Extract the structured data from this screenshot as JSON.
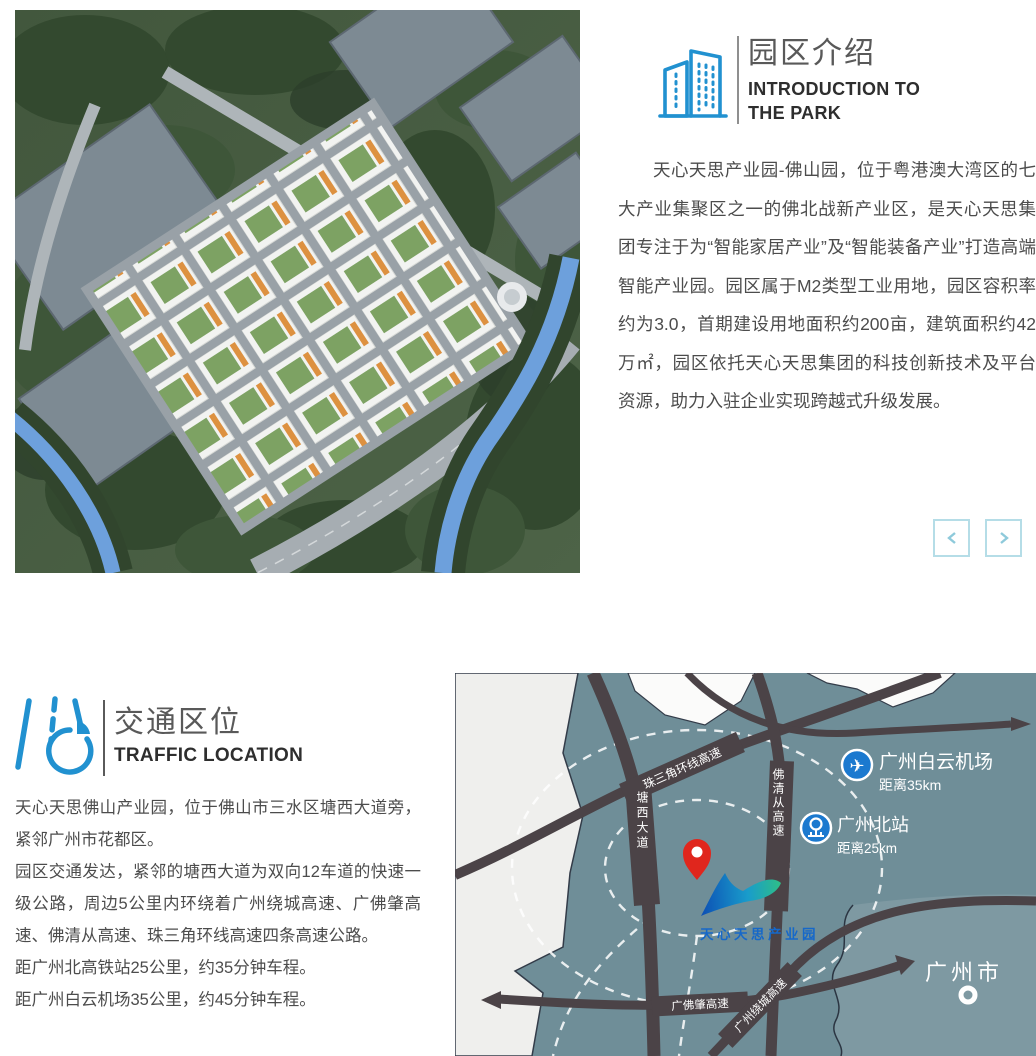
{
  "intro": {
    "title": "园区介绍",
    "subtitle": "INTRODUCTION TO THE PARK",
    "paragraph": "天心天思产业园-佛山园，位于粤港澳大湾区的七大产业集聚区之一的佛北战新产业区，是天心天思集团专注于为“智能家居产业”及“智能装备产业”打造高端智能产业园。园区属于M2类型工业用地，园区容积率约为3.0，首期建设用地面积约200亩，建筑面积约42万㎡，园区依托天心天思集团的科技创新技术及平台资源，助力入驻企业实现跨越式升级发展。"
  },
  "carousel": {
    "prev_label": "‹",
    "next_label": "›"
  },
  "traffic": {
    "title": "交通区位",
    "subtitle": "TRAFFIC LOCATION",
    "paragraphs": [
      "天心天思佛山产业园，位于佛山市三水区塘西大道旁，紧邻广州市花都区。",
      "园区交通发达，紧邻的塘西大道为双向12车道的快速一级公路，周边5公里内环绕着广州绕城高速、广佛肇高速、佛清从高速、珠三角环线高速四条高速公路。",
      "距广州北高铁站25公里，约35分钟车程。",
      "距广州白云机场35公里，约45分钟车程。"
    ]
  },
  "map": {
    "park_label": "天心天思产业园",
    "airport_name": "广州白云机场",
    "airport_distance": "距离35km",
    "station_name": "广州北站",
    "station_distance": "距离25km",
    "city_name": "广州市",
    "road_tangxi": "塘西大道",
    "road_foqingcong": "佛清从高速",
    "road_zhusanjiao": "珠三角环线高速",
    "road_guangfozhao": "广佛肇高速",
    "road_raocheng": "广州绕城高速"
  },
  "colors": {
    "accent_blue": "#2191d0",
    "map_label_blue": "#1668c9",
    "pin_red": "#e0261d",
    "road_dark": "#4b4347",
    "carousel_border": "#b5dde7"
  }
}
